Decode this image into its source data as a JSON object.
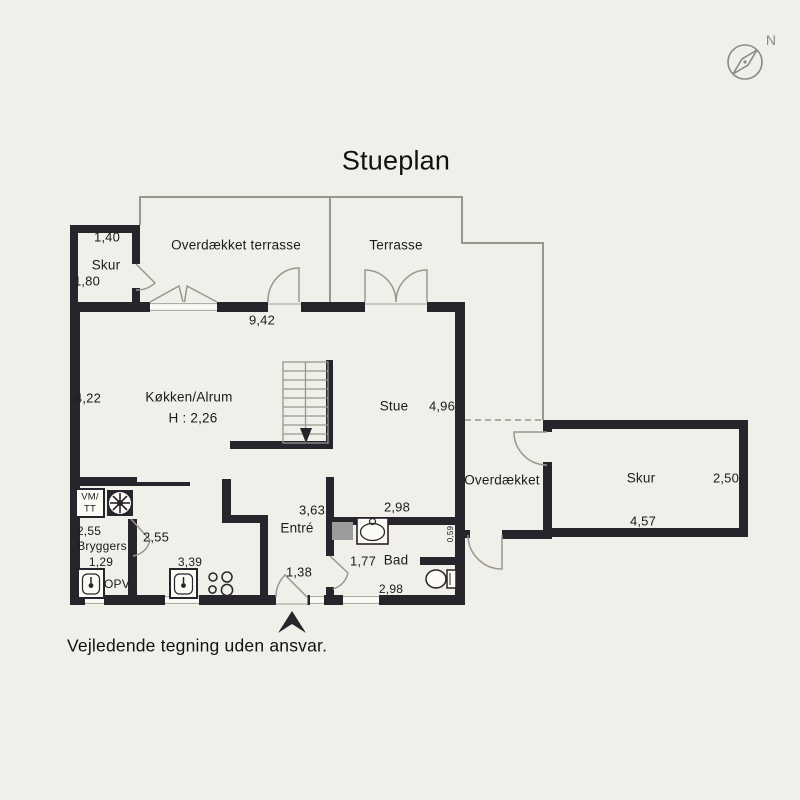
{
  "title": "Stueplan",
  "compass": {
    "north_label": "N"
  },
  "colors": {
    "background": "#f0efe9",
    "wall": "#28242b",
    "thin_line": "#98978f",
    "text": "#1b1b1b",
    "cabinet_gray": "#9c9c9c"
  },
  "rooms": {
    "skur_left": {
      "name": "Skur",
      "dim_width": "1,40",
      "dim_depth": "1,80"
    },
    "overdaekket_terrasse": {
      "name": "Overdækket terrasse"
    },
    "terrasse": {
      "name": "Terrasse"
    },
    "koekken_alrum": {
      "name": "Køkken/Alrum",
      "ceiling_height": "H : 2,26",
      "dim_width": "9,42",
      "dim_depth": "4,22"
    },
    "stue": {
      "name": "Stue",
      "dim_width": "4,96"
    },
    "entre": {
      "name": "Entré",
      "dim_depth": "3,63",
      "dim_width": "1,38"
    },
    "bad": {
      "name": "Bad",
      "dim_width_top": "2,98",
      "dim_depth": "1,77",
      "dim_width_bottom": "2,98",
      "dim_wall": "0,59"
    },
    "bryggers": {
      "name": "Bryggers",
      "dim_width": "2,55",
      "dim_small": "1,29",
      "dim_right": "2,55",
      "dim_kitchen": "3,39"
    },
    "overdaekket": {
      "name": "Overdækket"
    },
    "skur_right": {
      "name": "Skur",
      "dim_depth": "2,50",
      "dim_width": "4,57"
    }
  },
  "appliances": {
    "washer_dryer_line1": "VM/",
    "washer_dryer_line2": "TT",
    "dishwasher": "OPV"
  },
  "footer": {
    "disclaimer": "Vejledende tegning uden ansvar."
  }
}
